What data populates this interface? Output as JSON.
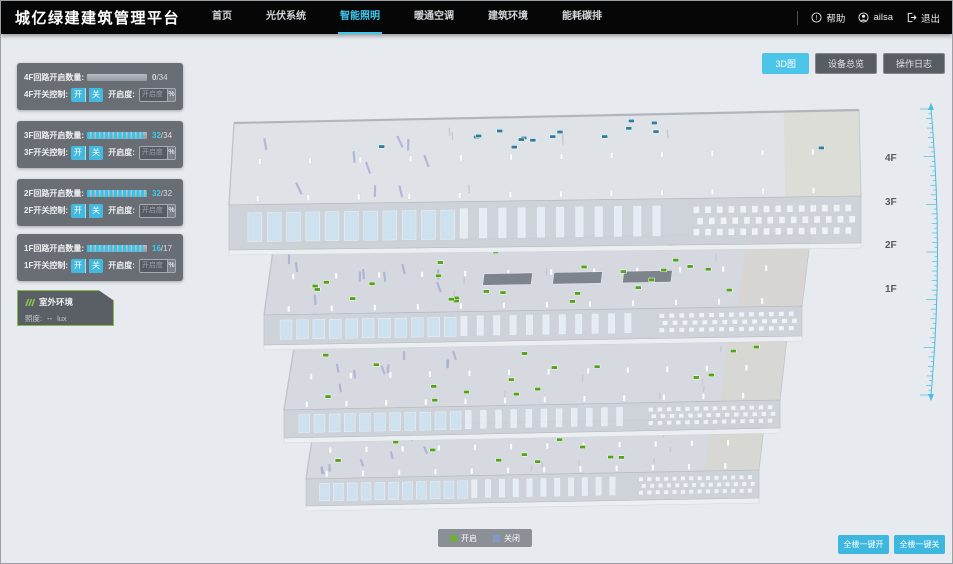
{
  "header": {
    "title": "城亿绿建建筑管理平台",
    "nav": [
      {
        "label": "首页",
        "active": false
      },
      {
        "label": "光伏系统",
        "active": false
      },
      {
        "label": "智能照明",
        "active": true
      },
      {
        "label": "暖通空调",
        "active": false
      },
      {
        "label": "建筑环境",
        "active": false
      },
      {
        "label": "能耗碳排",
        "active": false
      }
    ],
    "help_label": "帮助",
    "user_name": "ailsa",
    "logout_label": "退出"
  },
  "view_buttons": [
    {
      "label": "3D图",
      "active": true
    },
    {
      "label": "设备总览",
      "active": false
    },
    {
      "label": "操作日志",
      "active": false
    }
  ],
  "floor_panels": [
    {
      "count_label": "4F回路开启数量:",
      "value": 0,
      "total": 34,
      "value_text": "0",
      "total_text": "/34",
      "value_color": "#d9dde1",
      "switch_label": "4F开关控制:",
      "on_label": "开",
      "off_label": "关",
      "dim_label": "开启度:",
      "dim_placeholder": "开启度",
      "percent_label": "%"
    },
    {
      "count_label": "3F回路开启数量:",
      "value": 32,
      "total": 34,
      "value_text": "32",
      "total_text": "/34",
      "value_color": "#3fc9f0",
      "switch_label": "3F开关控制:",
      "on_label": "开",
      "off_label": "关",
      "dim_label": "开启度:",
      "dim_placeholder": "开启度",
      "percent_label": "%"
    },
    {
      "count_label": "2F回路开启数量:",
      "value": 32,
      "total": 32,
      "value_text": "32",
      "total_text": "/32",
      "value_color": "#3fc9f0",
      "switch_label": "2F开关控制:",
      "on_label": "开",
      "off_label": "关",
      "dim_label": "开启度:",
      "dim_placeholder": "开启度",
      "percent_label": "%"
    },
    {
      "count_label": "1F回路开启数量:",
      "value": 16,
      "total": 17,
      "value_text": "16",
      "total_text": "/17",
      "value_color": "#3fc9f0",
      "switch_label": "1F开关控制:",
      "on_label": "开",
      "off_label": "关",
      "dim_label": "开启度:",
      "dim_placeholder": "开启度",
      "percent_label": "%"
    }
  ],
  "outdoor": {
    "title": "室外环境",
    "lux_label": "照度:",
    "lux_value": "--",
    "lux_unit": "lux"
  },
  "floor_labels": [
    {
      "label": "4F"
    },
    {
      "label": "3F"
    },
    {
      "label": "2F"
    },
    {
      "label": "1F"
    }
  ],
  "legend": {
    "on_label": "开启",
    "off_label": "关闭",
    "on_color": "#6fae3a",
    "off_color": "#7f9ac4"
  },
  "bottom_buttons": [
    {
      "label": "全楼一键开"
    },
    {
      "label": "全楼一键关"
    }
  ],
  "colors": {
    "accent": "#3fc9f0",
    "panel": "#5f646b",
    "header_bg": "#060607"
  },
  "building": {
    "floors": [
      {
        "name": "4F",
        "marker_color": "#2f7e9b",
        "marker_count": 16
      },
      {
        "name": "3F",
        "marker_color": "#55a21c",
        "marker_count": 26
      },
      {
        "name": "2F",
        "marker_color": "#55a21c",
        "marker_count": 16
      },
      {
        "name": "1F",
        "marker_color": "#55a21c",
        "marker_count": 10
      }
    ]
  }
}
